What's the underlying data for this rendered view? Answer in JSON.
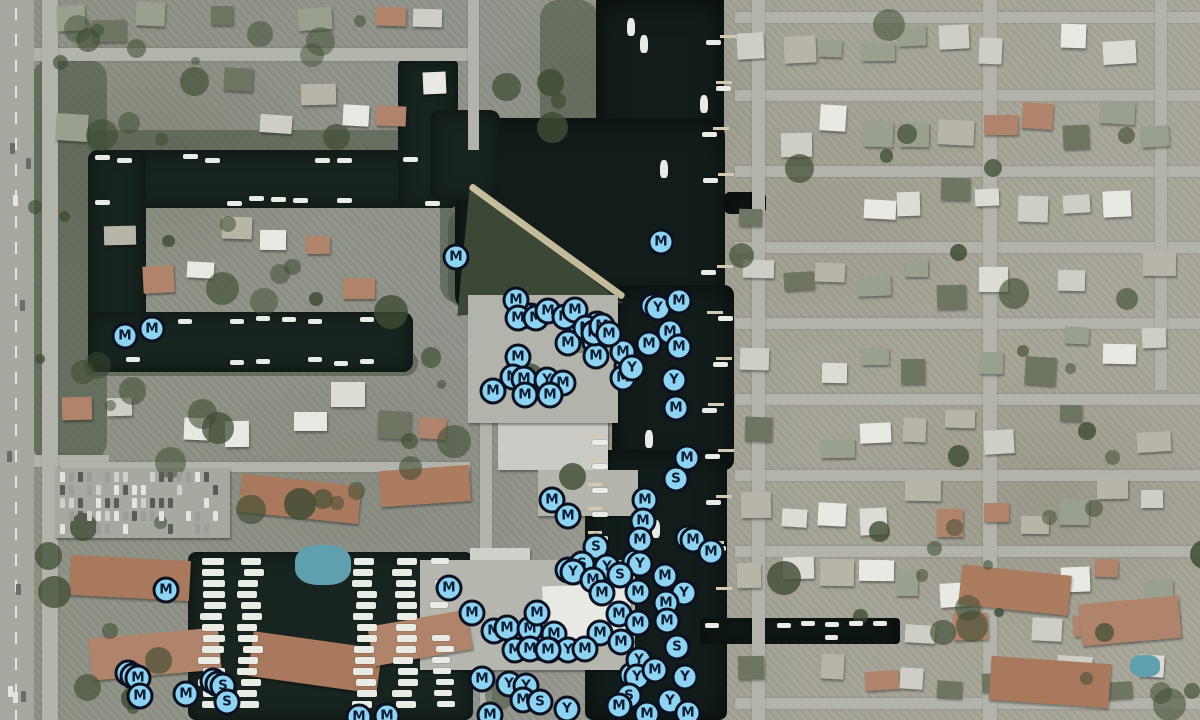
{
  "app": {
    "view": "satellite-map-with-poi-markers",
    "marker_types": {
      "M": "M",
      "Y": "Y",
      "S": "S"
    },
    "colors": {
      "marker_fill": "#8ed3f2",
      "marker_border": "#0b1120",
      "marker_letter": "#0c1c33",
      "water": "#18241f",
      "channel": "#121d1b",
      "road": "#b2b4ab",
      "sand": "#d8cdaa",
      "tree": "#46523f",
      "roof_terracotta": "#b0846a",
      "roof_gray": "#cfcec6",
      "roof_white": "#e8e9e3"
    },
    "map": {
      "water": [
        [
          596,
          0,
          128,
          185,
          0
        ],
        [
          455,
          118,
          270,
          195,
          18
        ],
        [
          612,
          285,
          122,
          185,
          10
        ],
        [
          585,
          450,
          142,
          270,
          8
        ],
        [
          700,
          618,
          200,
          26,
          4
        ],
        [
          724,
          192,
          42,
          22,
          6
        ],
        [
          88,
          150,
          360,
          58,
          10
        ],
        [
          88,
          150,
          58,
          222,
          10
        ],
        [
          88,
          312,
          325,
          60,
          10
        ],
        [
          398,
          58,
          60,
          150,
          8
        ],
        [
          430,
          110,
          70,
          90,
          10
        ],
        [
          188,
          552,
          285,
          168,
          8
        ]
      ],
      "roads_h": [
        [
          34,
          48,
          440,
          13
        ],
        [
          34,
          455,
          75,
          12
        ],
        [
          60,
          462,
          410,
          10
        ],
        [
          735,
          12,
          465,
          11
        ],
        [
          735,
          90,
          465,
          11
        ],
        [
          735,
          166,
          465,
          11
        ],
        [
          735,
          242,
          465,
          11
        ],
        [
          735,
          318,
          465,
          11
        ],
        [
          735,
          394,
          465,
          11
        ],
        [
          735,
          470,
          465,
          11
        ],
        [
          735,
          546,
          465,
          11
        ],
        [
          735,
          698,
          465,
          11
        ]
      ],
      "roads_v": [
        [
          42,
          0,
          16,
          720
        ],
        [
          468,
          0,
          11,
          150
        ],
        [
          480,
          400,
          12,
          320
        ],
        [
          752,
          0,
          13,
          720
        ],
        [
          983,
          0,
          14,
          720
        ],
        [
          1155,
          0,
          12,
          390
        ]
      ],
      "greens": [
        [
          540,
          0,
          58,
          135
        ],
        [
          440,
          138,
          120,
          165
        ],
        [
          88,
          130,
          370,
          26
        ],
        [
          88,
          350,
          330,
          26
        ],
        [
          32,
          60,
          75,
          400
        ],
        [
          448,
          208,
          40,
          100
        ]
      ],
      "peninsula": {
        "x": 452,
        "y": 178,
        "w": 178,
        "h": 142,
        "poly": "10% 5%, 96% 88%, 3% 97%"
      },
      "sand_strip": {
        "x": 452,
        "y": 238,
        "w": 190,
        "h": 7,
        "rot": 36
      },
      "buildings": [
        [
          498,
          412,
          110,
          58,
          0,
          "#c9cbc4"
        ],
        [
          538,
          470,
          100,
          46,
          0,
          "#b4b6ae"
        ],
        [
          470,
          548,
          60,
          30,
          0,
          "#cfd0c9"
        ],
        [
          468,
          295,
          150,
          128,
          0,
          "#b2b4ac"
        ],
        [
          420,
          560,
          215,
          110,
          0,
          "#b5b7af"
        ],
        [
          543,
          585,
          88,
          55,
          -2,
          "#e8e9e3"
        ],
        [
          240,
          480,
          120,
          38,
          6,
          "#a8795c"
        ],
        [
          380,
          468,
          90,
          36,
          -4,
          "#ab7c5e"
        ],
        [
          70,
          558,
          120,
          40,
          3,
          "#a8795c"
        ],
        [
          90,
          633,
          130,
          42,
          -5,
          "#b0846a"
        ],
        [
          250,
          640,
          130,
          45,
          8,
          "#a8795c"
        ],
        [
          370,
          618,
          100,
          40,
          -10,
          "#b0846a"
        ],
        [
          960,
          570,
          110,
          40,
          6,
          "#ab7c5e"
        ],
        [
          1080,
          600,
          100,
          42,
          -5,
          "#b0846a"
        ],
        [
          990,
          660,
          120,
          44,
          4,
          "#a8795c"
        ],
        [
          55,
          468,
          175,
          70,
          0,
          "#a7a9a1"
        ]
      ],
      "pools": [
        [
          295,
          545,
          56,
          40
        ],
        [
          1130,
          655,
          30,
          22
        ]
      ],
      "markers": [
        [
          "M",
          456,
          257,
          1
        ],
        [
          "M",
          661,
          242,
          1
        ],
        [
          "Y",
          658,
          308,
          2
        ],
        [
          "M",
          679,
          301,
          1
        ],
        [
          "M",
          516,
          300,
          1
        ],
        [
          "M",
          518,
          318,
          1
        ],
        [
          "M",
          536,
          318,
          2
        ],
        [
          "M",
          548,
          311,
          1
        ],
        [
          "M",
          565,
          317,
          1
        ],
        [
          "M",
          575,
          310,
          1
        ],
        [
          "M",
          568,
          343,
          1
        ],
        [
          "M",
          595,
          342,
          1
        ],
        [
          "M",
          596,
          356,
          1
        ],
        [
          "M",
          623,
          352,
          1
        ],
        [
          "M",
          649,
          344,
          1
        ],
        [
          "M",
          670,
          332,
          1
        ],
        [
          "M",
          679,
          347,
          1
        ],
        [
          "M",
          623,
          378,
          1
        ],
        [
          "Y",
          632,
          368,
          2
        ],
        [
          "Y",
          674,
          380,
          1
        ],
        [
          "M",
          676,
          408,
          1
        ],
        [
          "M",
          518,
          357,
          1
        ],
        [
          "M",
          513,
          377,
          1
        ],
        [
          "M",
          524,
          379,
          1
        ],
        [
          "Y",
          547,
          380,
          1
        ],
        [
          "M",
          563,
          383,
          1
        ],
        [
          "M",
          493,
          391,
          1
        ],
        [
          "M",
          525,
          395,
          1
        ],
        [
          "M",
          550,
          395,
          1
        ],
        [
          "M",
          586,
          328,
          2
        ],
        [
          "M",
          594,
          333,
          1
        ],
        [
          "M",
          602,
          326,
          2
        ],
        [
          "M",
          609,
          334,
          1
        ],
        [
          "M",
          125,
          336,
          1
        ],
        [
          "M",
          152,
          329,
          1
        ],
        [
          "M",
          687,
          458,
          1
        ],
        [
          "S",
          676,
          479,
          1
        ],
        [
          "M",
          552,
          500,
          1
        ],
        [
          "M",
          568,
          516,
          1
        ],
        [
          "M",
          645,
          500,
          1
        ],
        [
          "M",
          643,
          521,
          1
        ],
        [
          "M",
          640,
          540,
          1
        ],
        [
          "M",
          693,
          540,
          2
        ],
        [
          "M",
          711,
          552,
          1
        ],
        [
          "M",
          166,
          590,
          1
        ],
        [
          "M",
          449,
          588,
          1
        ],
        [
          "M",
          138,
          678,
          3
        ],
        [
          "M",
          140,
          696,
          1
        ],
        [
          "M",
          186,
          694,
          1
        ],
        [
          "S",
          223,
          686,
          3
        ],
        [
          "S",
          227,
          702,
          1
        ],
        [
          "S",
          596,
          547,
          1
        ],
        [
          "S",
          582,
          564,
          1
        ],
        [
          "Y",
          573,
          572,
          2
        ],
        [
          "Y",
          607,
          567,
          1
        ],
        [
          "Y",
          640,
          564,
          2
        ],
        [
          "S",
          620,
          575,
          1
        ],
        [
          "M",
          593,
          580,
          1
        ],
        [
          "M",
          602,
          593,
          1
        ],
        [
          "M",
          638,
          592,
          1
        ],
        [
          "M",
          665,
          576,
          1
        ],
        [
          "Y",
          684,
          593,
          1
        ],
        [
          "M",
          666,
          603,
          1
        ],
        [
          "M",
          619,
          614,
          1
        ],
        [
          "M",
          638,
          623,
          1
        ],
        [
          "M",
          667,
          621,
          1
        ],
        [
          "M",
          600,
          633,
          1
        ],
        [
          "M",
          554,
          634,
          1
        ],
        [
          "M",
          549,
          650,
          1
        ],
        [
          "Y",
          568,
          650,
          1
        ],
        [
          "M",
          585,
          649,
          1
        ],
        [
          "M",
          621,
          642,
          1
        ],
        [
          "Y",
          639,
          660,
          1
        ],
        [
          "S",
          677,
          647,
          1
        ],
        [
          "Y",
          637,
          677,
          2
        ],
        [
          "M",
          655,
          670,
          1
        ],
        [
          "Y",
          685,
          677,
          1
        ],
        [
          "S",
          629,
          696,
          1
        ],
        [
          "Y",
          670,
          701,
          1
        ],
        [
          "M",
          619,
          706,
          1
        ],
        [
          "Y",
          567,
          709,
          1
        ],
        [
          "M",
          647,
          714,
          1
        ],
        [
          "M",
          472,
          613,
          1
        ],
        [
          "M",
          494,
          631,
          1
        ],
        [
          "M",
          507,
          628,
          1
        ],
        [
          "M",
          530,
          629,
          1
        ],
        [
          "M",
          537,
          613,
          1
        ],
        [
          "M",
          515,
          650,
          1
        ],
        [
          "M",
          530,
          649,
          1
        ],
        [
          "M",
          548,
          650,
          2
        ],
        [
          "M",
          482,
          679,
          1
        ],
        [
          "Y",
          509,
          684,
          1
        ],
        [
          "Y",
          526,
          686,
          1
        ],
        [
          "M",
          523,
          700,
          1
        ],
        [
          "S",
          540,
          702,
          1
        ],
        [
          "M",
          490,
          715,
          1
        ],
        [
          "M",
          359,
          717,
          1
        ],
        [
          "M",
          387,
          716,
          1
        ],
        [
          "M",
          688,
          713,
          1
        ]
      ]
    }
  }
}
